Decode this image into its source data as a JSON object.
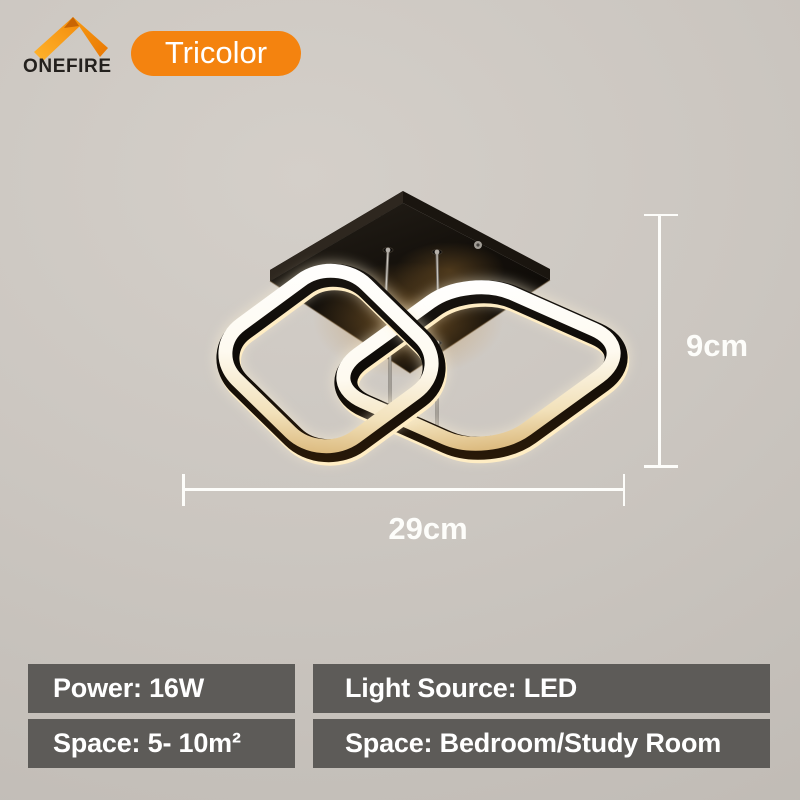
{
  "background_color": "#cbc6c0",
  "brand": {
    "name": "ONEFIRE",
    "logo_icon": "orange-roof-chevron",
    "logo_colors": {
      "left_arm": "#f9a61c",
      "right_arm": "#ee7f02",
      "fold": "#c96504"
    },
    "text_color": "#24211e"
  },
  "badge": {
    "label": "Tricolor",
    "bg_color": "#f4830f",
    "text_color": "#ffffff"
  },
  "photo": {
    "subject": "black LED ceiling lamp with two interlocked rounded-square glowing rings under a square canopy",
    "frame_color": "#0d0a07",
    "glow_color": "#fff8ea"
  },
  "dimensions": {
    "line_color": "#fdfdfa",
    "height": {
      "label": "9cm"
    },
    "width": {
      "label": "29cm"
    }
  },
  "specs": {
    "bar_bg": "#5d5b58",
    "text_color": "#ffffff",
    "items": [
      {
        "id": "power",
        "text": "Power: 16W"
      },
      {
        "id": "light-source",
        "text": "Light Source: LED"
      },
      {
        "id": "space-size",
        "text": "Space: 5- 10m²"
      },
      {
        "id": "space-rooms",
        "text": "Space: Bedroom/Study Room"
      }
    ]
  }
}
